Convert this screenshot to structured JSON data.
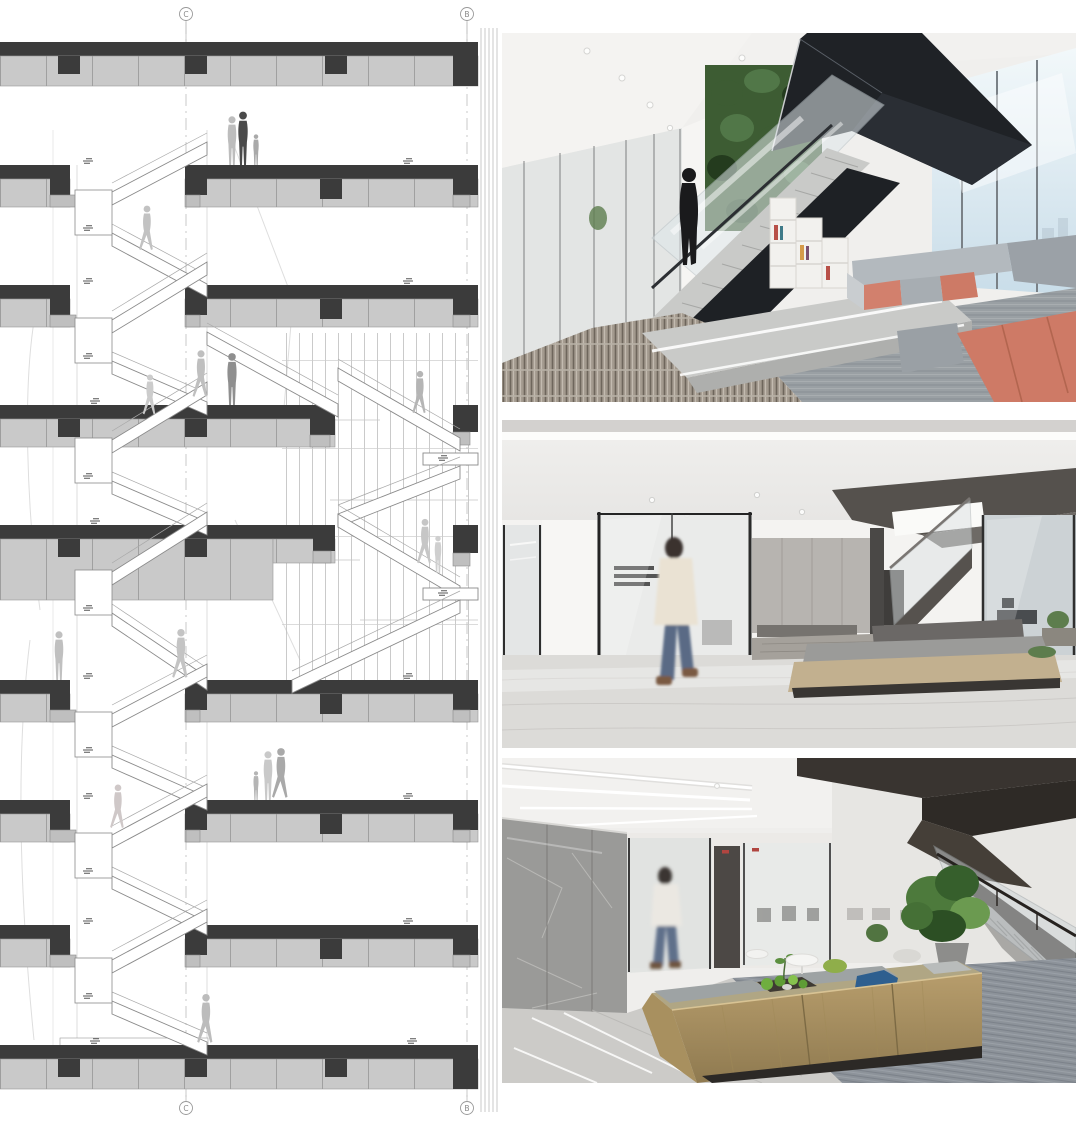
{
  "page": {
    "kind": "architectural presentation board: staircase section drawing with three interior photographs",
    "background": "#ffffff"
  },
  "section": {
    "grid_bubble_top_left": "C",
    "grid_bubble_top_right": "B",
    "grid_bubble_bottom_left": "C",
    "grid_bubble_bottom_right": "B",
    "colors": {
      "slab_panel": "#c9c9c9",
      "slab_band": "#3b3b3b",
      "stair_line": "#8a8a8a",
      "figure_light": "#c2c2c2",
      "figure_dark": "#4a4a4a",
      "mullion": "#b8b8b8"
    }
  },
  "photos": {
    "top": {
      "colors": {
        "steel_stair": "#1f2226",
        "plant_wall": "#3d5c33",
        "coral_sofa": "#d2806d",
        "coral_sofa_deep": "#ce7a66",
        "gray_sofa": "#a7adb2",
        "corridor_carpet": "#a39a8e",
        "window_sky": "#cfe0ea",
        "marble": "#c9cac8"
      }
    },
    "middle": {
      "colors": {
        "bench_base": "#c2b08f",
        "bench_cushion": "#9b9b99",
        "backrest": "#6b6866",
        "floor_marble": "#dcdbd8",
        "frame_black": "#2b2b2b",
        "jacket_cream": "#eae2d3",
        "jeans_blue": "#5a6b85"
      }
    },
    "bottom": {
      "colors": {
        "bronze_bench": "#a8905f",
        "bronze_light": "#b79d6c",
        "moss_green": "#5f9c35",
        "stool_blue": "#2e5f8f",
        "stool_green": "#8fae4a",
        "stone_wall": "#9a9a98",
        "stair_steel": "#3b352f",
        "carpet": "#8d939a"
      }
    }
  }
}
